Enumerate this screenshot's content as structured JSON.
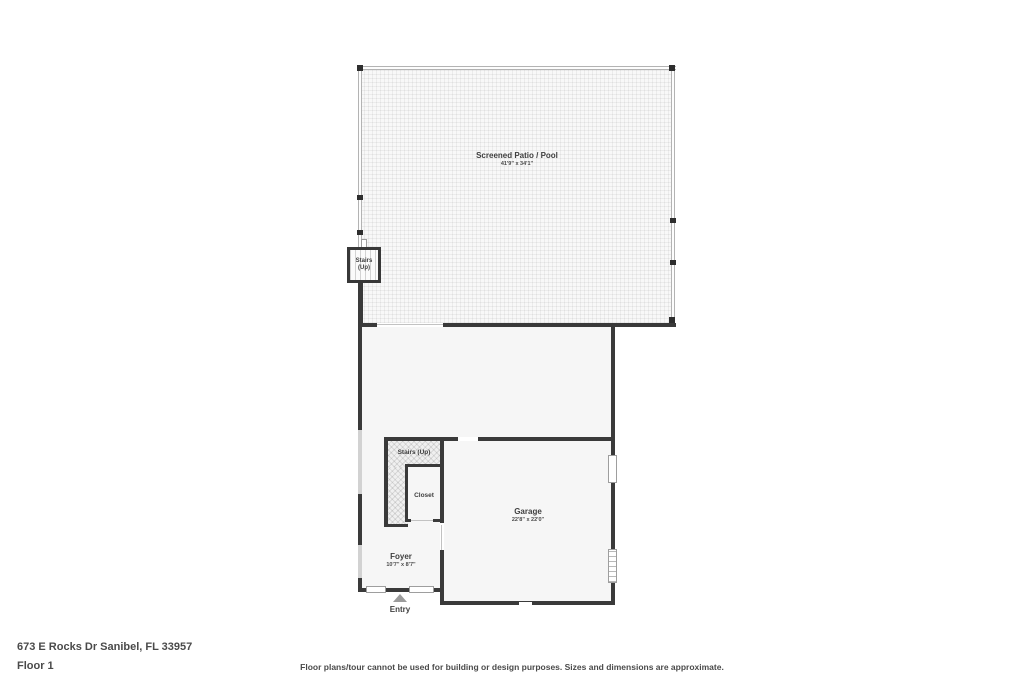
{
  "floorplan": {
    "patio": {
      "label": "Screened Patio / Pool",
      "dims": "41'9\" x 34'1\""
    },
    "patio_stairs": {
      "line1": "Stairs",
      "line2": "(Up)"
    },
    "stairs": {
      "label": "Stairs (Up)"
    },
    "closet": {
      "label": "Closet"
    },
    "garage": {
      "label": "Garage",
      "dims": "22'8\" x 22'0\""
    },
    "foyer": {
      "label": "Foyer",
      "dims": "10'7\" x 8'7\""
    },
    "entry": {
      "label": "Entry"
    }
  },
  "footer": {
    "address": "673 E Rocks Dr Sanibel, FL 33957",
    "floor_label": "Floor 1",
    "disclaimer": "Floor plans/tour cannot be used for building or design purposes. Sizes and dimensions are approximate."
  },
  "colors": {
    "wall": "#3a3a3a",
    "room_fill": "#f6f6f6",
    "patio_fill": "#f8f8f8",
    "label_text": "#3f3f3f",
    "footer_text": "#4a4a4a"
  }
}
